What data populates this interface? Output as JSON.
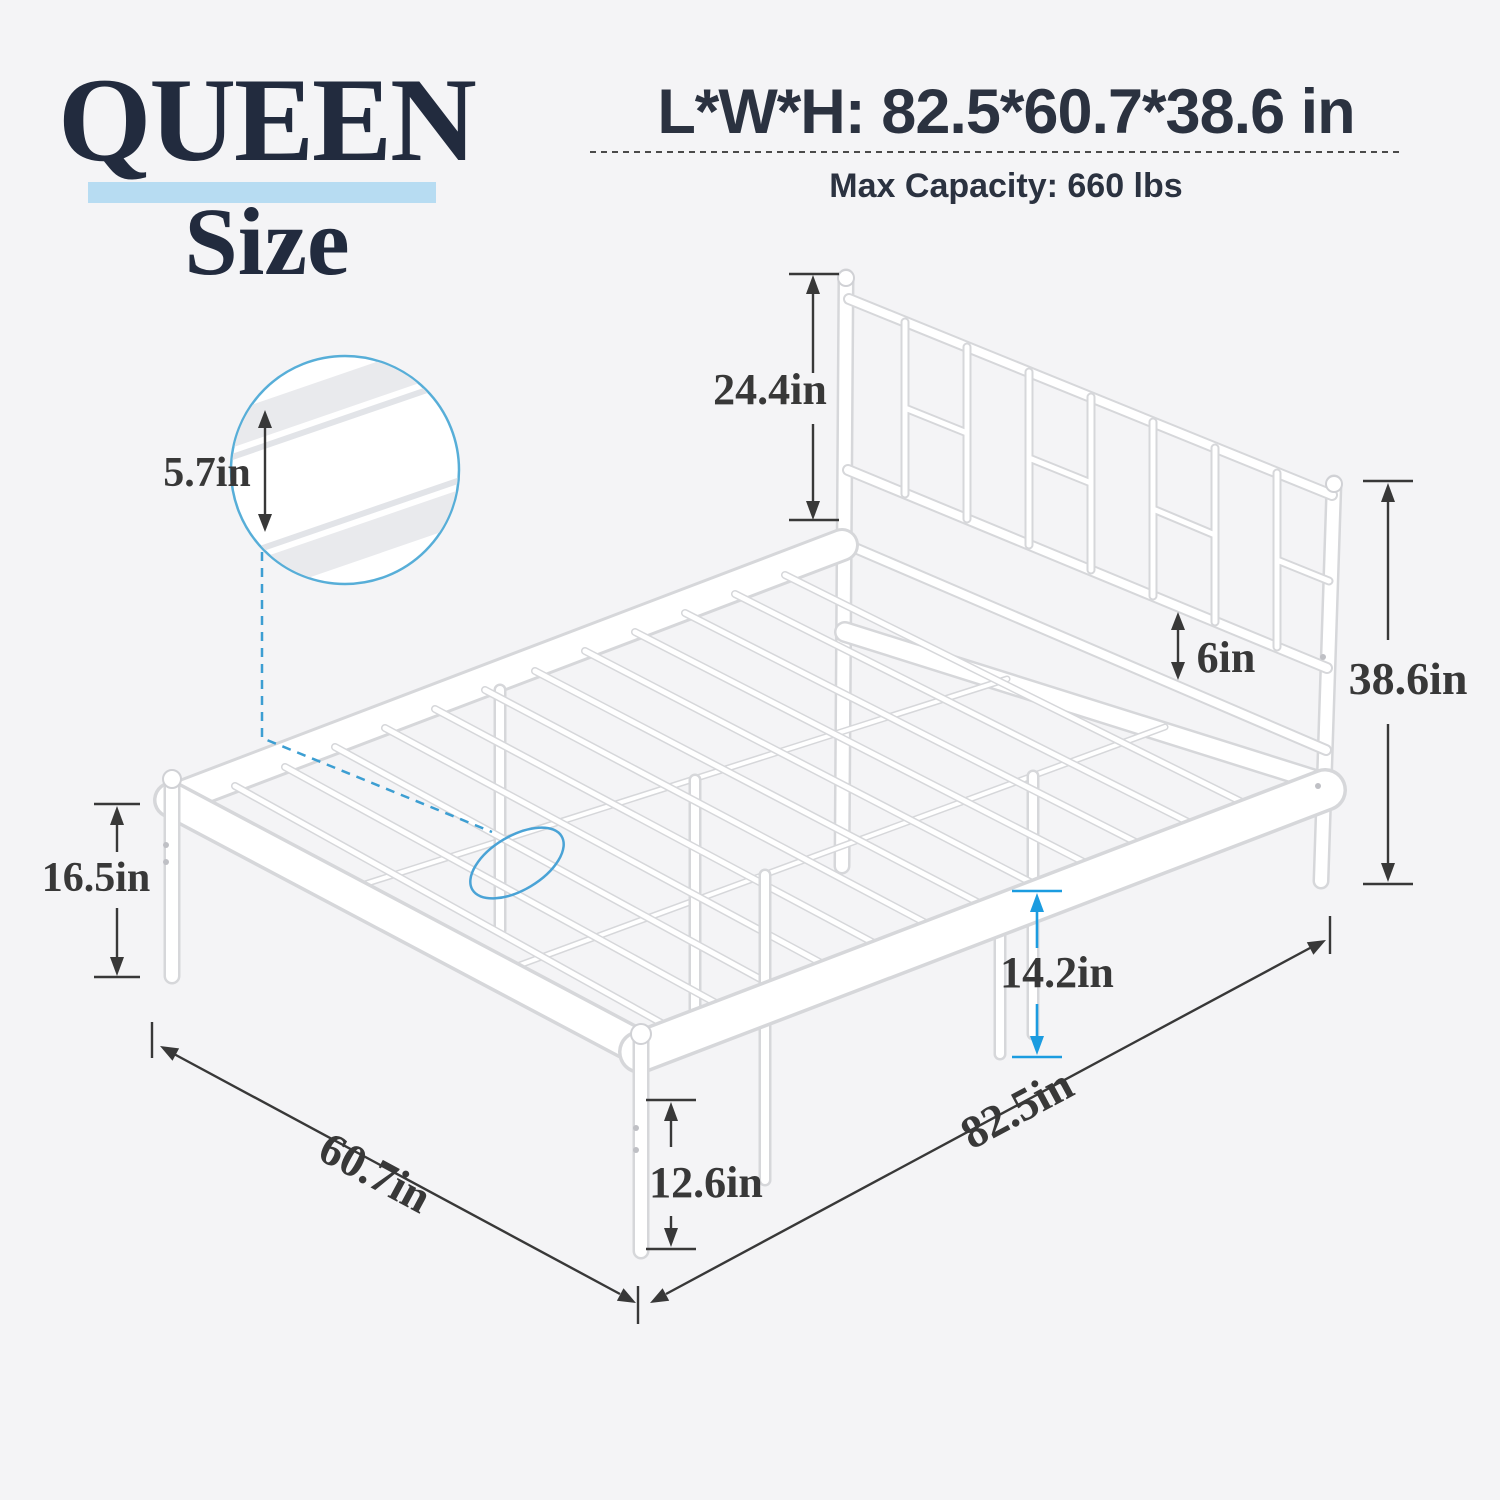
{
  "title_block": {
    "size": "QUEEN",
    "size_word": "Size"
  },
  "spec_header": {
    "dimensions_title": "L*W*H: 82.5*60.7*38.6 in",
    "max_capacity": "Max Capacity: 660 lbs"
  },
  "annotations": {
    "headboard_height": "24.4in",
    "side_rail_height": "5.7in",
    "headboard_bottom_gap": "6in",
    "overall_height": "38.6in",
    "platform_top_height": "16.5in",
    "center_clearance": "14.2in",
    "corner_clearance": "12.6in",
    "bed_width": "60.7in",
    "bed_length": "82.5in"
  },
  "colors": {
    "background": "#f4f4f6",
    "heading_navy": "#222b3e",
    "underline_blue": "#b7dcf2",
    "dimension_text": "#383838",
    "accent_blue": "#1b9ce0",
    "magnifier_blue": "#57aed8",
    "leader_blue": "#3c9ed2",
    "ellipse_blue": "#4aa3d6",
    "tube_edge": "#d6d7da",
    "tube_fill": "#ffffff"
  }
}
